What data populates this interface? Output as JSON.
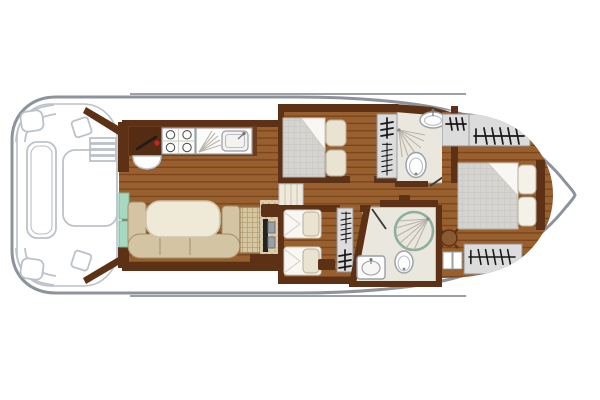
{
  "diagram": {
    "type": "boat-floor-plan",
    "view": "top-down",
    "bow_direction": "right",
    "regions": [
      "stern-deck",
      "galley",
      "saloon-dinette",
      "helm-station",
      "companionway",
      "double-cabin",
      "twin-cabin",
      "corridor",
      "shower-room-top",
      "shower-room-bottom",
      "bow-cabin"
    ],
    "fixtures": [
      "deck-table",
      "deck-side-bench",
      "deck-corner-bench",
      "deck-stool",
      "boarding-steps",
      "entry-steps",
      "stove",
      "kitchen-sink",
      "throttle-lever",
      "helm-seat",
      "dinette-table",
      "u-bench",
      "wicker-seat",
      "companionway-ladder",
      "corridor-steps",
      "double-bed",
      "twin-beds",
      "pillows",
      "wardrobe-hangers",
      "washbasin",
      "toilet",
      "corner-shower",
      "round-shower",
      "stool",
      "bedside-cabinet",
      "step-boxes"
    ]
  },
  "palette": {
    "hull": "#8d939c",
    "deckline": "#bcc2c9",
    "wood": "#99602f",
    "woodline": "#7a4318",
    "wall": "#5d3115",
    "counter": "#6e3b1c",
    "mattress": "#d5d4d1",
    "pillow": "#e9e3d2",
    "bedding": "#f8f7f3",
    "bench": "#d3c5a3",
    "table": "#efe9d8",
    "mint": "#a7d9c1",
    "bath": "#eae7de",
    "fixture": "#fdfdfd",
    "showerring": "#8fae9b",
    "wardrobe": "#dcdcdc",
    "symbol": "#17181a",
    "stool": "#8a5a33",
    "accentred": "#cc2222"
  }
}
